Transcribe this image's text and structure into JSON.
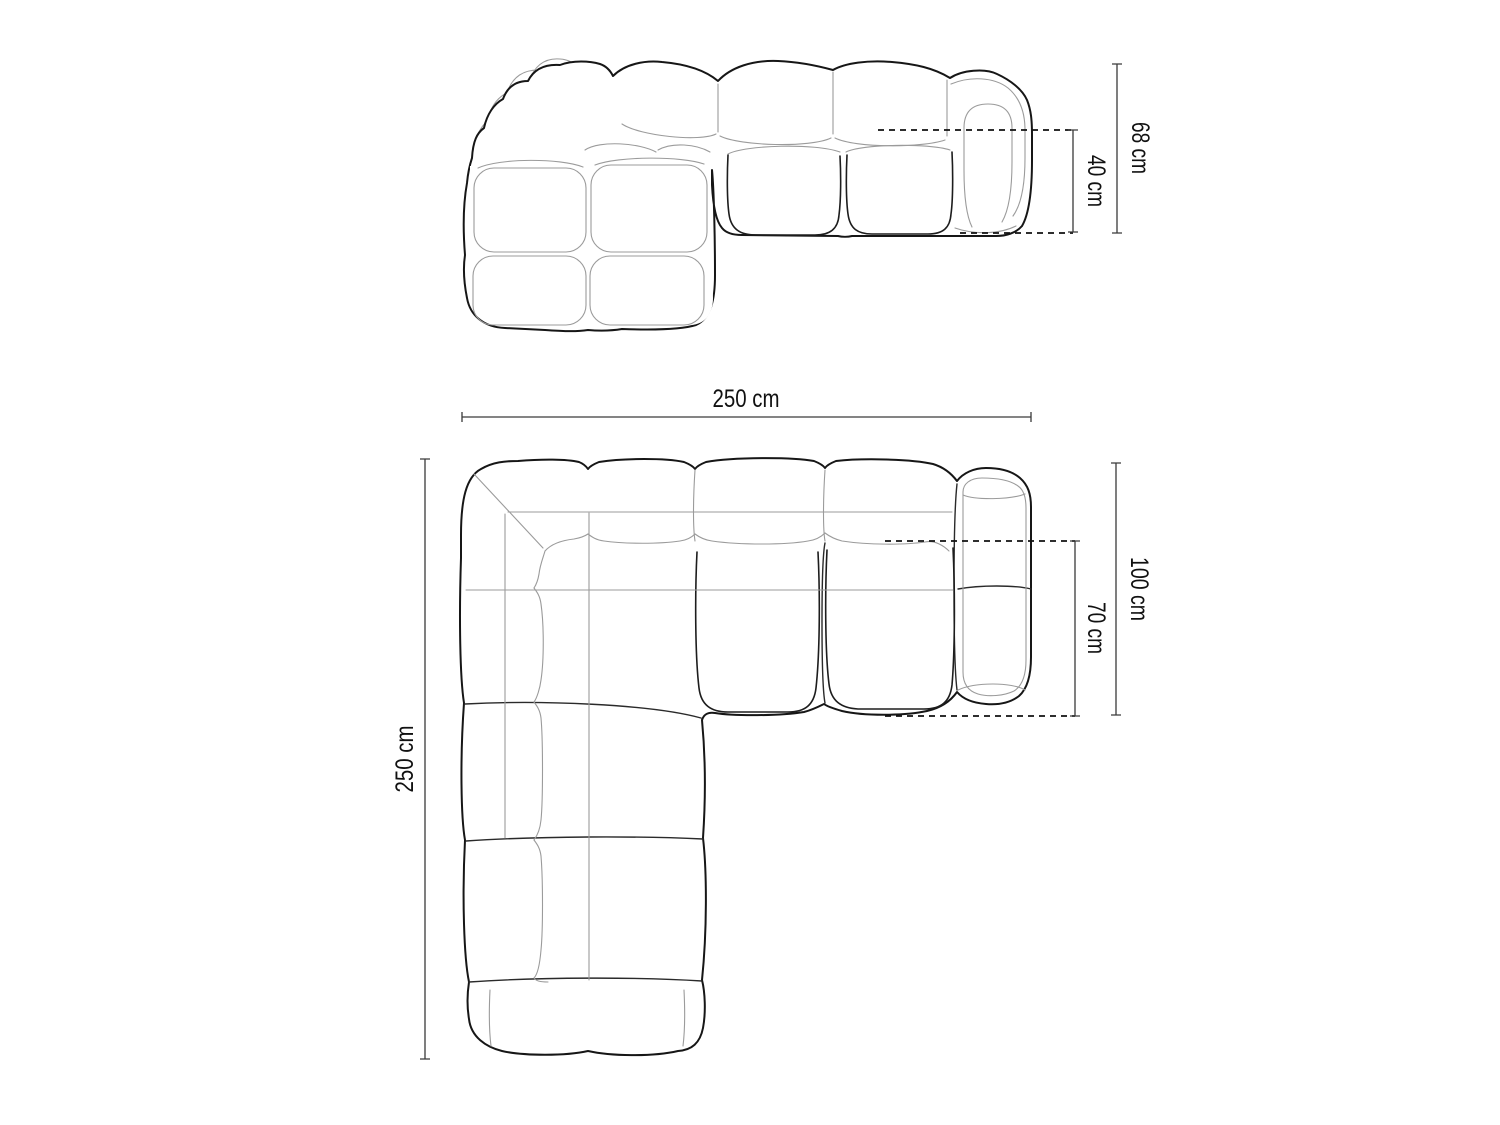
{
  "diagram": {
    "product": "modular corner sofa technical drawing",
    "views": {
      "front_elevation": {
        "total_height_label": "68 cm",
        "seat_height_label": "40 cm"
      },
      "top_plan": {
        "total_width_label": "250 cm",
        "total_depth_label": "250 cm",
        "side_depth_label": "100 cm",
        "seat_depth_label": "70 cm"
      }
    }
  },
  "colors": {
    "background": "#ffffff",
    "outline": "#161616",
    "inner_line": "#9b9b9b",
    "dimension_line": "#3a3a3a",
    "label_text": "#111111"
  }
}
